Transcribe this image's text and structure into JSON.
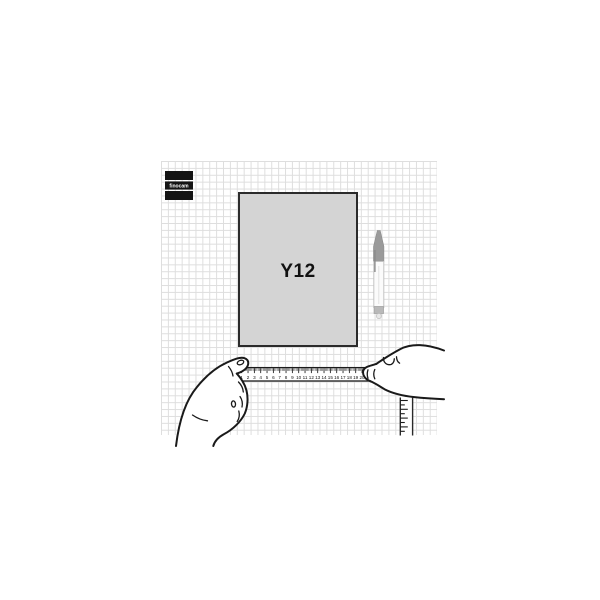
{
  "page": {
    "background": "#ffffff"
  },
  "logo": {
    "text": "finocam",
    "bg_color": "#141414",
    "text_color": "#ffffff"
  },
  "grid": {
    "line_color": "#dedede",
    "cell_px": 6.9
  },
  "product": {
    "label": "Y12",
    "fill": "#d4d4d4",
    "border_color": "#2b2b2b",
    "label_color": "#111111"
  },
  "ruler": {
    "numbers": [
      "1",
      "2",
      "3",
      "4",
      "5",
      "6",
      "7",
      "8",
      "9",
      "10",
      "11",
      "12",
      "13",
      "14",
      "15",
      "16",
      "17",
      "18",
      "19",
      "20",
      "21"
    ],
    "ink": "#1b1b1b",
    "fill": "#ffffff"
  },
  "icons": {
    "pen": "ballpoint-pen-icon",
    "left_hand": "left-hand-holding-ruler-icon",
    "right_hand": "right-hand-holding-ruler-icon",
    "horizontal_ruler": "horizontal-ruler-icon",
    "vertical_ruler": "vertical-ruler-icon"
  }
}
